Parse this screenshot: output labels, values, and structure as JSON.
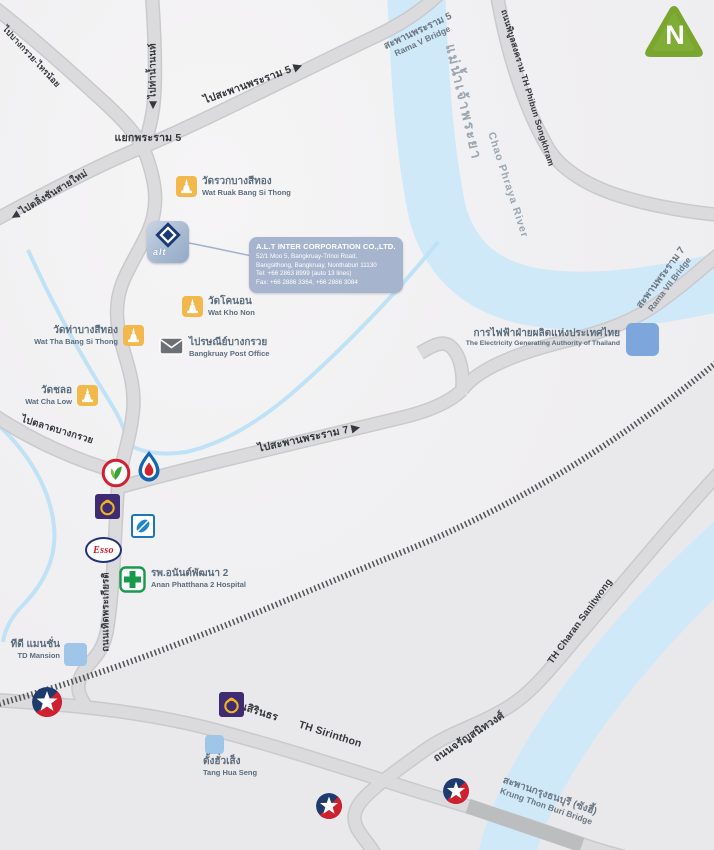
{
  "compass": {
    "letter": "N"
  },
  "brands": {
    "esso": "Esso"
  },
  "company": {
    "logo_text": "alt",
    "name": "A.L.T INTER CORPORATION CO.,LTD.",
    "address_line1": "52/1 Moo 5, Bangkruay-Trinoi Road,",
    "address_line2": "Bangsithong, Bangkruay, Nonthaburi 11130",
    "tel": "Tel:  +66 2863 8999 (auto 13 lines)",
    "fax": "Fax: +66 2886 3364, +66 2886 3084"
  },
  "river": {
    "th": "แม่น้ำเจ้าพระยา",
    "en": "Chao Phraya River"
  },
  "bridges": {
    "rama5": {
      "th": "สะพานพระราม 5",
      "en": "Rama V Bridge"
    },
    "rama7": {
      "th": "สะพานพระราม 7",
      "en": "Rama VII Bridge"
    },
    "krungthon": {
      "th": "สะพานกรุงธนบุรี (ซังฮี้)",
      "en": "Krung Thon Buri Bridge"
    }
  },
  "roads": {
    "to_rama5": "ไปสะพานพระราม 5 ▶",
    "junction_rama5": "แยกพระราม 5",
    "to_tha_nam_non": "◀ ไปท่าน้ำนนท์",
    "to_bangkruay_sainoi": "ไปบางกรวย-ไทรน้อย",
    "to_taling_chan": "◀ ไปตลิ่งชันสายใหม่",
    "phibun": "ถนนพิบูลสงคราม   TH Phibun Songkhram",
    "to_rama7": "ไปสะพานพระราม 7 ▶",
    "to_bangkruay_market": "ไปตลาดบางกรวย",
    "thoet_phra_kiat": "ถนนเทิดพระเกียรติ",
    "sirinthon_th": "ถนนสิรินธร",
    "sirinthon_en": "TH Sirinthon",
    "charan_en": "TH Charan Sanitwong",
    "charan_th": "ถนนจรัญสนิทวงศ์"
  },
  "places": {
    "wat_ruak": {
      "th": "วัดรวกบางสีทอง",
      "en": "Wat Ruak Bang Si Thong"
    },
    "wat_kho_non": {
      "th": "วัดโคนอน",
      "en": "Wat Kho Non"
    },
    "wat_tha": {
      "th": "วัดท่าบางสีทอง",
      "en": "Wat Tha Bang Si Thong"
    },
    "wat_cha_low": {
      "th": "วัดชลอ",
      "en": "Wat Cha Low"
    },
    "post_office": {
      "th": "ไปรษณีย์บางกรวย",
      "en": "Bangkruay Post Office"
    },
    "egat": {
      "th": "การไฟฟ้าฝ่ายผลิตแห่งประเทศไทย",
      "en": "The Electricity Generating Authority of Thailand"
    },
    "hospital": {
      "th": "รพ.อนันต์พัฒนา 2",
      "en": "Anan Phatthana 2 Hospital"
    },
    "td_mansion": {
      "th": "ทีดี แมนชั่น",
      "en": "TD Mansion"
    },
    "tang_hua_seng": {
      "th": "ตั้งฮั่วเส็ง",
      "en": "Tang Hua Seng"
    }
  },
  "colors": {
    "river": "#cfe9f9",
    "road": "#dbdbdd",
    "railway": "#55565a",
    "temple": "#f2b84b",
    "hospital_green": "#179a4b",
    "scb_purple": "#3f2b72",
    "caltex_navy": "#1d3b6d",
    "caltex_red": "#cf2030",
    "compass_green": "#7aa62f",
    "infobox": "#a7b4cd",
    "egat_blue": "#7da7dc"
  }
}
